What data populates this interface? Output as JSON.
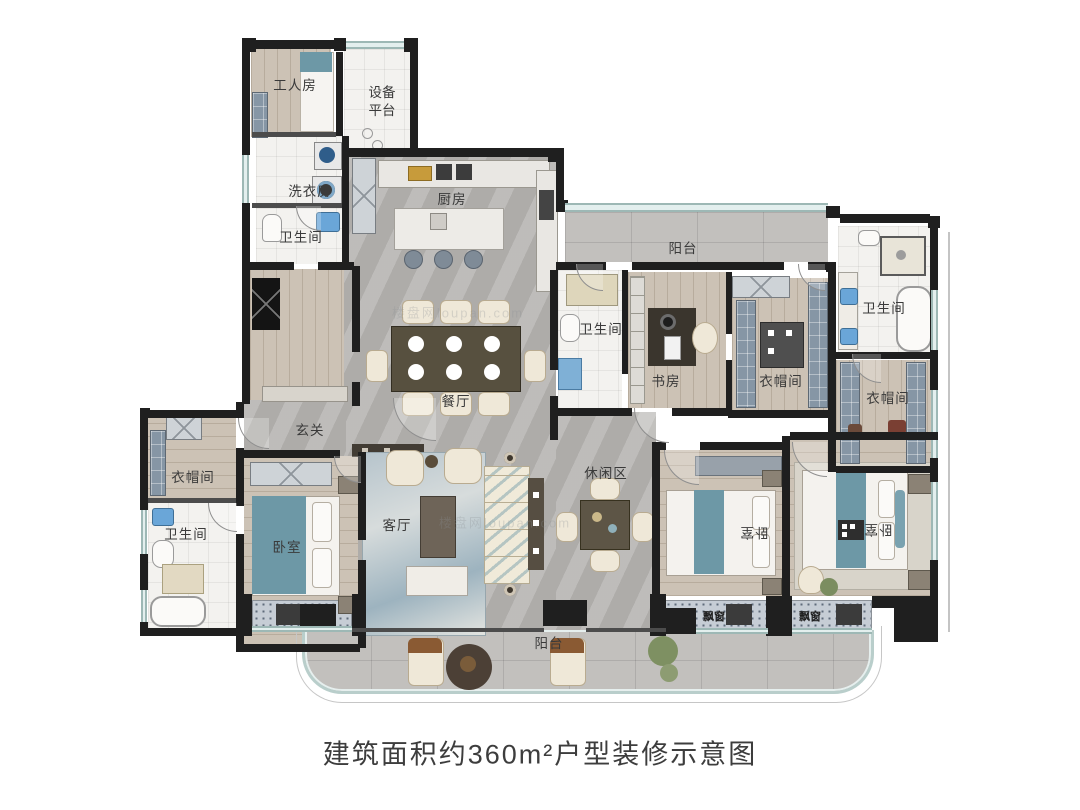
{
  "caption": "建筑面积约360m²户型装修示意图",
  "watermark": "楼盘网loupan.com",
  "labels": {
    "worker_room": "工人房",
    "equipment_platform": "设备平台",
    "laundry_room": "洗衣房",
    "bathroom": "卫生间",
    "kitchen": "厨房",
    "balcony": "阳台",
    "study": "书房",
    "cloakroom": "衣帽间",
    "dining_room": "餐厅",
    "foyer": "玄关",
    "living_room": "客厅",
    "leisure_area": "休闲区",
    "bedroom": "卧室",
    "bay_window": "飘窗"
  },
  "colors": {
    "wall": "#1f1f1f",
    "teal_bedding": "#6d98a6",
    "wood_floor": "#ccc2b5",
    "marble_floor": "#b7b5b2",
    "window_glass": "#e3efee",
    "fixture_blue": "#6aa6d8",
    "caption_text": "#3d3d3d"
  }
}
